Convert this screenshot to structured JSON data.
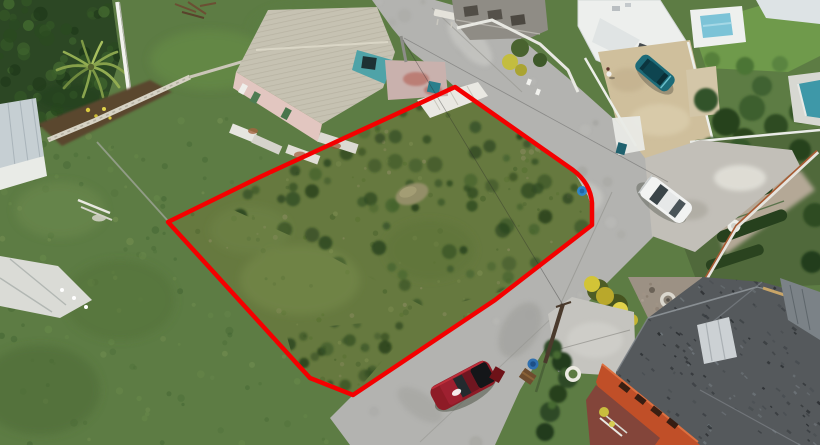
{
  "scene": {
    "kind": "aerial-drone-photograph",
    "subject": "vacant grass land plot outlined in red beside a curved concrete road",
    "boundary": {
      "color": "#f40000",
      "stroke_width": 4.5,
      "vertices": [
        [
          455,
          87
        ],
        [
          573,
          170
        ],
        [
          592,
          203
        ],
        [
          592,
          225
        ],
        [
          495,
          300
        ],
        [
          353,
          395
        ],
        [
          310,
          378
        ],
        [
          168,
          222
        ],
        [
          262,
          176
        ]
      ]
    },
    "vehicles": [
      {
        "label": "red-suv",
        "color": "#8e1b26",
        "location": "road bottom center"
      },
      {
        "label": "white-sedan",
        "color": "#f2f3f2",
        "location": "road right junction"
      },
      {
        "label": "teal-hatchback",
        "color": "#1d6b78",
        "location": "driveway top right"
      }
    ],
    "objects": [
      "warehouse with corrugated roof",
      "palm tree",
      "white utility pole",
      "unfinished concrete house",
      "white modern house",
      "two swimming pools",
      "beige driveway",
      "gravel yard",
      "dark shingle hip roof house",
      "orange wall with window slots",
      "courtyard fountain",
      "bird bath",
      "blue barrels",
      "hedge rows",
      "yellow flowering bushes",
      "person on driveway",
      "wood power pole",
      "rubble stone wall"
    ],
    "colors": {
      "boundary": "#f40000",
      "road": "#b3b3b0",
      "lot_grass": "#66793f",
      "lawn_grass": "#5d7c44",
      "warehouse_roof": "#c6c2b2",
      "warehouse_wall_pink": "#e2c6c0",
      "warehouse_gable_teal": "#4fa3a8",
      "driveway_beige": "#cfbf9c",
      "gravel": "#c2bfb8",
      "pool_light": "#7cc3d7",
      "pool_teal": "#3e98a8",
      "house_white": "#edefed",
      "unfinished_concrete": "#8f8c85",
      "big_roof": "#55595c",
      "orange_wall": "#c04f28",
      "courtyard": "#9c9184",
      "apron_concrete": "#c5c4bf",
      "red_car": "#8e1b26",
      "white_car": "#f2f3f2",
      "teal_car": "#1d6b78",
      "hedge_dark": "#2e4926",
      "rust_rail": "#a85a32",
      "maroon_pavement": "#83453a"
    }
  }
}
